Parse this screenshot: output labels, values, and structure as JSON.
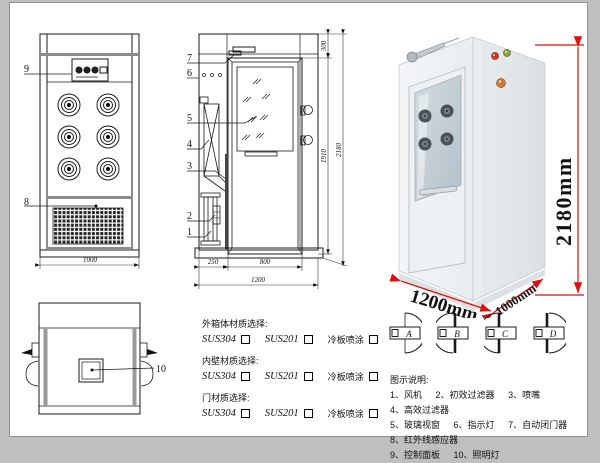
{
  "front_view": {
    "label_9": "9",
    "label_8": "8",
    "dim_width": "1000"
  },
  "section_view": {
    "label_7": "7",
    "label_6": "6",
    "label_5": "5",
    "label_4": "4",
    "label_3": "3",
    "label_2": "2",
    "label_1": "1",
    "dim_top": "300",
    "dim_door_height": "1910",
    "dim_total_height": "2180",
    "dim_left": "250",
    "dim_door_width": "800",
    "dim_total_width": "1200"
  },
  "plan_view": {
    "label_10": "10"
  },
  "photo": {
    "dim_height": "2180mm",
    "dim_width": "1200mm",
    "dim_depth": "1000mm",
    "dim_color": "#dd0f0f"
  },
  "materials": {
    "groups": [
      {
        "title": "外箱体材质选择:",
        "opt1": "SUS304",
        "opt2": "SUS201",
        "opt3": "冷板喷涂"
      },
      {
        "title": "内壁材质选择:",
        "opt1": "SUS304",
        "opt2": "SUS201",
        "opt3": "冷板喷涂"
      },
      {
        "title": "门材质选择:",
        "opt1": "SUS304",
        "opt2": "SUS201",
        "opt3": "冷板喷涂"
      }
    ]
  },
  "door_options": {
    "labels": [
      "A",
      "B",
      "C",
      "D"
    ]
  },
  "legend": {
    "title": "图示说明:",
    "items": [
      "1、风机",
      "2、初效过滤器",
      "3、喷嘴",
      "4、高效过滤器",
      "5、玻璃视窗",
      "6、指示灯",
      "7、自动闭门器",
      "8、红外线感应器",
      "9、控制面板",
      "10、照明灯"
    ]
  }
}
